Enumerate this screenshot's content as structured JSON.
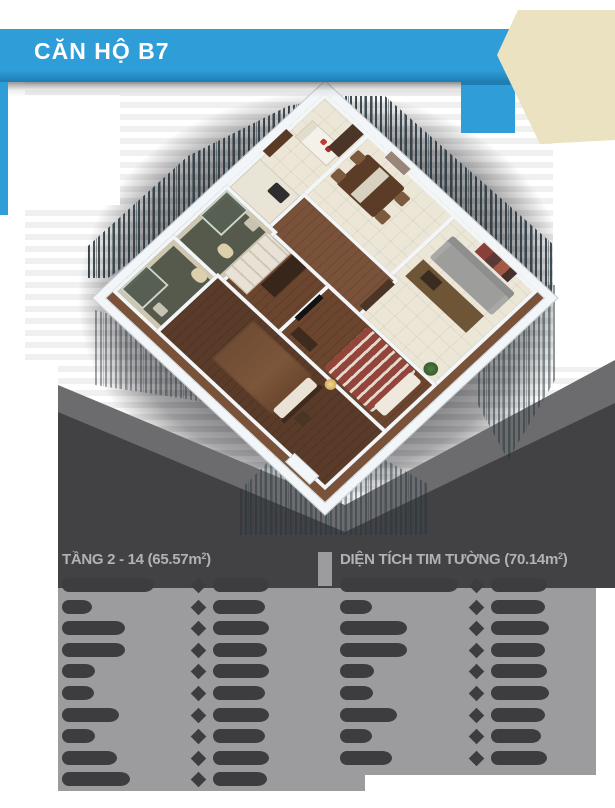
{
  "header": {
    "title": "CĂN HỘ B7",
    "colors": {
      "bar": "#2f9dd8",
      "bar_dark_edge": "#1f7db2",
      "banner_cream": "#ebe2c2"
    }
  },
  "floorplan": {
    "style": "3d-isometric-render",
    "colors": {
      "wall": "#f2f6f8",
      "tile_floor": "#ece6d7",
      "wood_floor": "#6b452e",
      "bath_floor": "#555a4d",
      "sofa": "#9d9d9b",
      "master_bed": "#6f4c34",
      "striped_bed": "#93453c",
      "backdrop_charcoal": "#424244",
      "glow_gray": "#646466"
    },
    "elements": [
      "kitchen",
      "dining",
      "living-room",
      "hallway",
      "wardrobe",
      "bathroom-1",
      "bathroom-2",
      "bedroom-2",
      "master-bedroom"
    ]
  },
  "tables": {
    "panel_color": "#9c9c9e",
    "blob_color": "#3d3d3f",
    "header_text_color": "#b2b2b4",
    "left": {
      "title": "TẦNG 2 - 14 (65.57m",
      "sup": "2",
      "title_close": ")",
      "rows": [
        [
          92,
          56
        ],
        [
          30,
          52
        ],
        [
          63,
          56
        ],
        [
          63,
          54
        ],
        [
          33,
          56
        ],
        [
          32,
          52
        ],
        [
          57,
          56
        ],
        [
          33,
          52
        ],
        [
          55,
          56
        ],
        [
          68,
          54
        ]
      ]
    },
    "right": {
      "title": "DIỆN TÍCH TIM TƯỜNG (70.14m",
      "sup": "2",
      "title_close": ")",
      "rows": [
        [
          118,
          56
        ],
        [
          32,
          54
        ],
        [
          67,
          58
        ],
        [
          67,
          54
        ],
        [
          34,
          56
        ],
        [
          33,
          58
        ],
        [
          57,
          54
        ],
        [
          32,
          50
        ],
        [
          52,
          56
        ]
      ]
    }
  }
}
